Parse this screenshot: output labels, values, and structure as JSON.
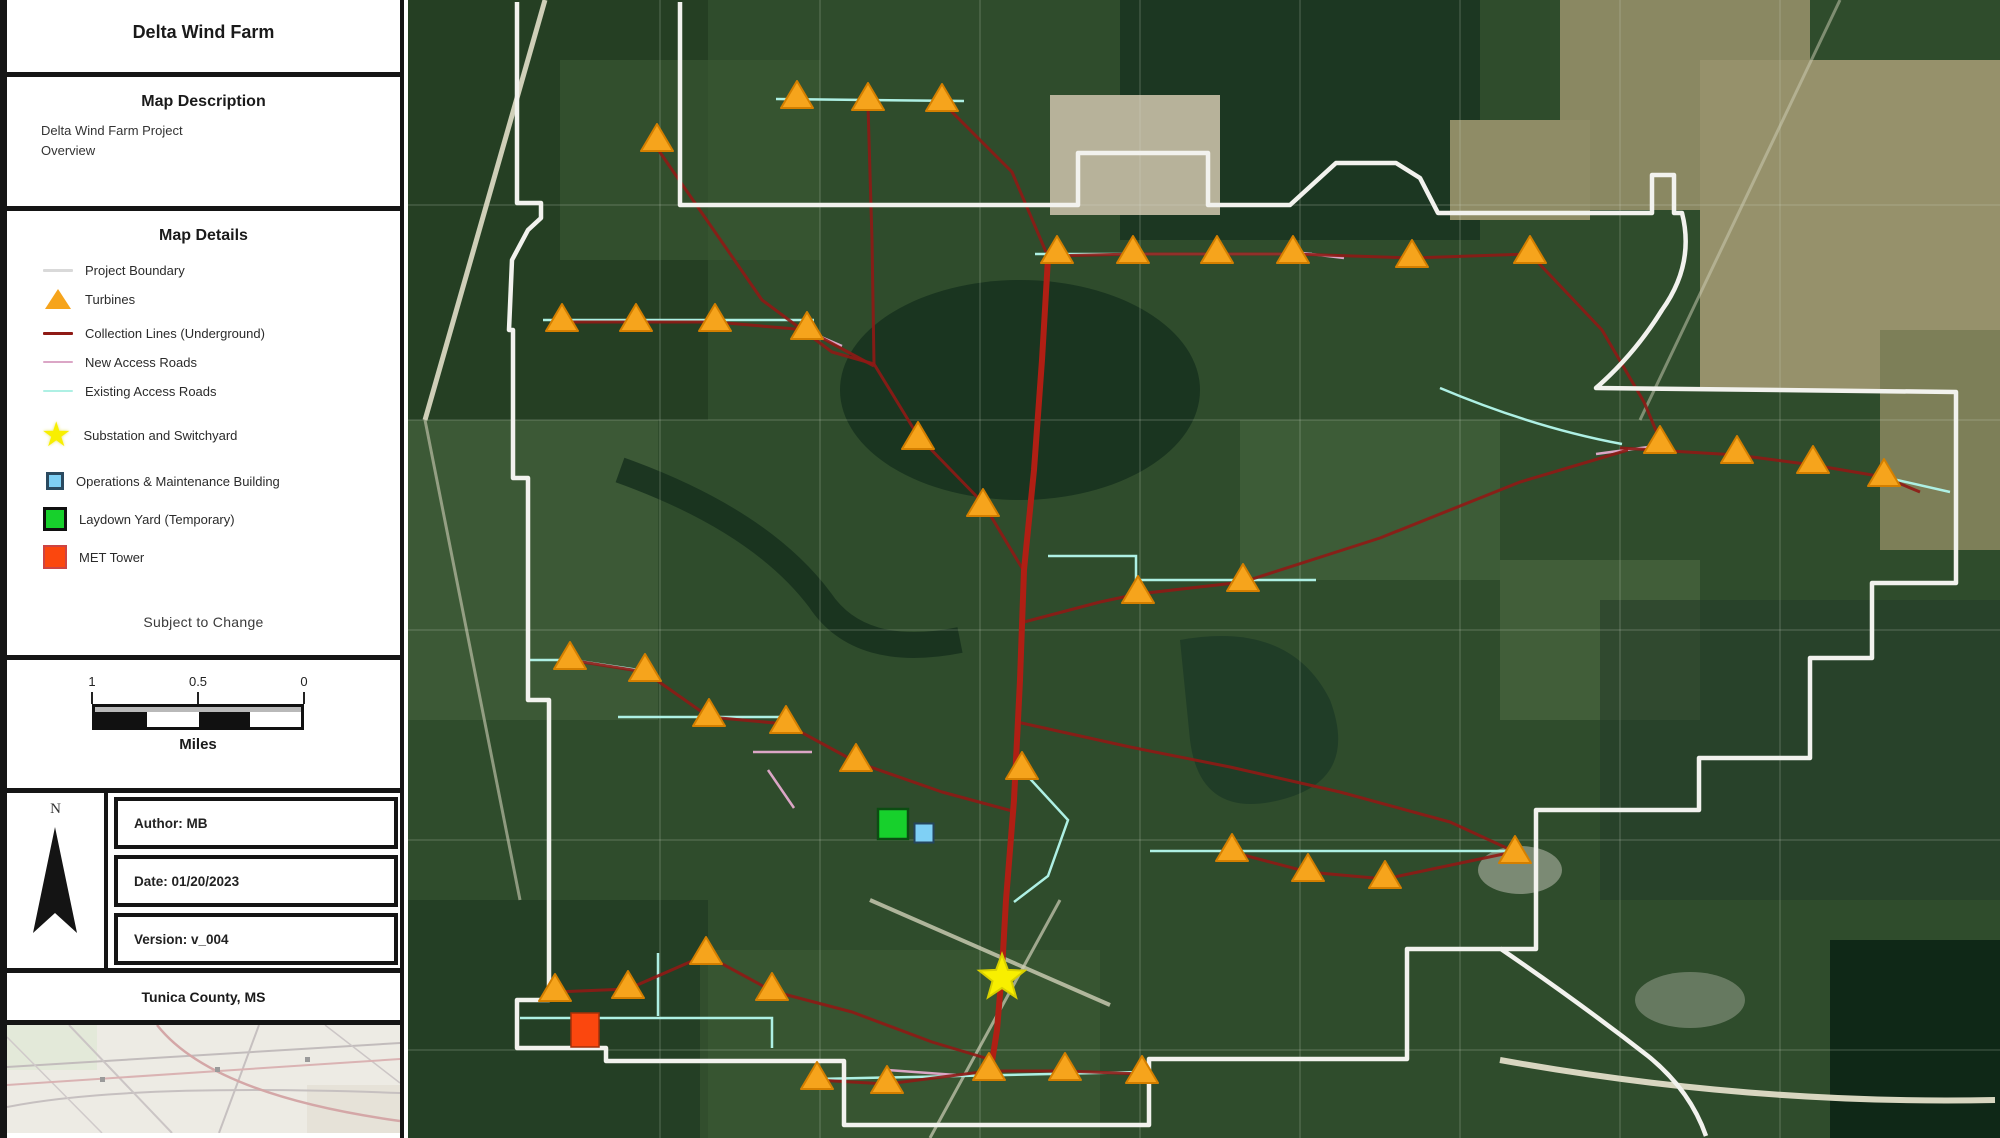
{
  "title": "Delta Wind Farm",
  "map_description": {
    "heading": "Map Description",
    "line1": "Delta Wind Farm Project",
    "line2": "Overview"
  },
  "map_details": {
    "heading": "Map Details",
    "items": [
      {
        "id": "project-boundary",
        "label": "Project Boundary"
      },
      {
        "id": "turbines",
        "label": "Turbines"
      },
      {
        "id": "collection-lines",
        "label": "Collection Lines (Underground)"
      },
      {
        "id": "new-access-roads",
        "label": "New Access Roads"
      },
      {
        "id": "existing-access-roads",
        "label": "Existing Access Roads"
      },
      {
        "id": "substation",
        "label": "Substation and Switchyard"
      },
      {
        "id": "om-building",
        "label": "Operations & Maintenance Building"
      },
      {
        "id": "laydown-yard",
        "label": "Laydown Yard (Temporary)"
      },
      {
        "id": "met-tower",
        "label": "MET Tower"
      }
    ],
    "note": "Subject to Change"
  },
  "scale_bar": {
    "labels": [
      "1",
      "0.5",
      "0"
    ],
    "unit": "Miles"
  },
  "meta": {
    "north_label": "N",
    "author": "Author: MB",
    "date": "Date: 01/20/2023",
    "version": "Version: v_004",
    "county": "Tunica County, MS"
  },
  "colors": {
    "boundary": "#f2f2ee",
    "boundary_legend": "#d9d9d9",
    "turbine": "#f6a41c",
    "turbine_stroke": "#d47f00",
    "collection": "#8f1a15",
    "collection_trunk": "#b01f14",
    "new_road": "#dba6c6",
    "existing_road": "#aef0e4",
    "substation": "#f8ef00",
    "om_building": "#7fd0f5",
    "laydown": "#17d02c",
    "met": "#fb470e"
  },
  "map": {
    "turbines": [
      [
        797,
        97
      ],
      [
        868,
        99
      ],
      [
        942,
        100
      ],
      [
        657,
        140
      ],
      [
        1057,
        252
      ],
      [
        1133,
        252
      ],
      [
        1217,
        252
      ],
      [
        1293,
        252
      ],
      [
        1412,
        256
      ],
      [
        1530,
        252
      ],
      [
        562,
        320
      ],
      [
        636,
        320
      ],
      [
        715,
        320
      ],
      [
        807,
        328
      ],
      [
        918,
        438
      ],
      [
        983,
        505
      ],
      [
        1660,
        442
      ],
      [
        1737,
        452
      ],
      [
        1813,
        462
      ],
      [
        1884,
        475
      ],
      [
        1138,
        592
      ],
      [
        1243,
        580
      ],
      [
        570,
        658
      ],
      [
        645,
        670
      ],
      [
        709,
        715
      ],
      [
        786,
        722
      ],
      [
        856,
        760
      ],
      [
        1022,
        768
      ],
      [
        1232,
        850
      ],
      [
        1308,
        870
      ],
      [
        1385,
        877
      ],
      [
        1515,
        852
      ],
      [
        555,
        990
      ],
      [
        628,
        987
      ],
      [
        706,
        953
      ],
      [
        772,
        989
      ],
      [
        817,
        1078
      ],
      [
        887,
        1082
      ],
      [
        989,
        1069
      ],
      [
        1065,
        1069
      ],
      [
        1142,
        1072
      ]
    ],
    "boundary_paths": [
      "M 517 2 L 517 203 L 541 203 L 541 218 L 528 230 L 512 260 L 509 330 L 513 330 L 513 478 L 528 478 L 528 700 L 549 700 L 549 1000 L 517 1000 L 517 1048 L 606 1048 L 606 1061 L 844 1061 L 844 1125 L 1149 1125 L 1149 1059 L 1407 1059 L 1407 949 L 1501 949 Q 1580 1003 1648 1056 Q 1690 1090 1706 1136",
      "M 680 2 L 680 205 L 1078 205 L 1078 153 L 1208 153 L 1208 205 L 1290 205 L 1336 163 L 1396 163 L 1420 178 L 1438 213 L 1652 213 L 1652 175 L 1674 175 L 1674 213 L 1682 213 Q 1695 264 1662 310 Q 1634 355 1596 388 L 1956 392 L 1956 583 L 1872 583 L 1872 658 L 1810 658 L 1810 758 L 1699 758 L 1699 810 L 1536 810 L 1536 949 L 1501 949"
    ],
    "collection_trunk": [
      "M 1048 258 L 1042 360 L 1034 470 L 1024 570 L 1020 680 L 1014 800 L 1006 900 L 1002 970 L 997 1030 L 991 1068"
    ],
    "collection_lines": [
      "M 657 148 L 762 300 L 832 352 L 874 364 L 918 436 L 983 503 L 1022 568",
      "M 868 106 L 872 240 L 874 364",
      "M 942 102 L 1012 172 L 1046 252",
      "M 1048 256 L 1135 254 L 1217 254 L 1293 254 L 1412 258 L 1530 254",
      "M 1530 254 L 1602 330 L 1644 402 L 1660 440",
      "M 1620 448 L 1737 455 L 1813 465 L 1884 477 L 1920 492",
      "M 1024 622 L 1100 602 L 1138 594 L 1243 582 L 1380 538 L 1520 482 L 1628 450",
      "M 1017 722 L 1130 747 L 1230 767 L 1340 792 L 1450 822 L 1511 850",
      "M 1232 852 L 1308 872 L 1385 879 L 1513 852",
      "M 562 322 L 636 322 L 715 322 L 807 330 L 874 366",
      "M 570 660 L 645 672 L 709 717 L 786 724 L 856 762 L 942 792 L 1016 812",
      "M 555 992 L 628 989 L 706 955 L 772 991 L 852 1012 L 932 1042 L 992 1060",
      "M 817 1080 L 887 1084 L 989 1071 L 1065 1071 L 1142 1074"
    ],
    "existing_roads": [
      "M 776 99 L 964 101",
      "M 1035 254 L 1312 254",
      "M 543 320 L 814 320",
      "M 1048 556 L 1136 556 L 1136 580 L 1316 580",
      "M 528 660 L 572 660 L 645 671",
      "M 618 717 L 788 717",
      "M 1150 851 L 1515 851",
      "M 520 1018 L 772 1018 L 772 1048",
      "M 658 953 L 658 1016",
      "M 817 1079 L 1142 1072",
      "M 1440 388 Q 1535 428 1622 444",
      "M 1884 477 L 1950 492",
      "M 1022 770 L 1068 820 L 1048 876 L 1014 902"
    ],
    "new_roads": [
      "M 753 752 L 812 752",
      "M 768 770 L 794 808",
      "M 888 1070 L 956 1075",
      "M 1294 252 L 1344 258",
      "M 805 330 L 842 346",
      "M 1596 454 L 1656 446"
    ],
    "substation": {
      "x": 1002,
      "y": 978
    },
    "laydown_yard": {
      "x": 893,
      "y": 824,
      "size": 30
    },
    "om_building": {
      "x": 924,
      "y": 833,
      "size": 19
    },
    "met_tower": {
      "x": 585,
      "y": 1025,
      "size": 28
    }
  }
}
